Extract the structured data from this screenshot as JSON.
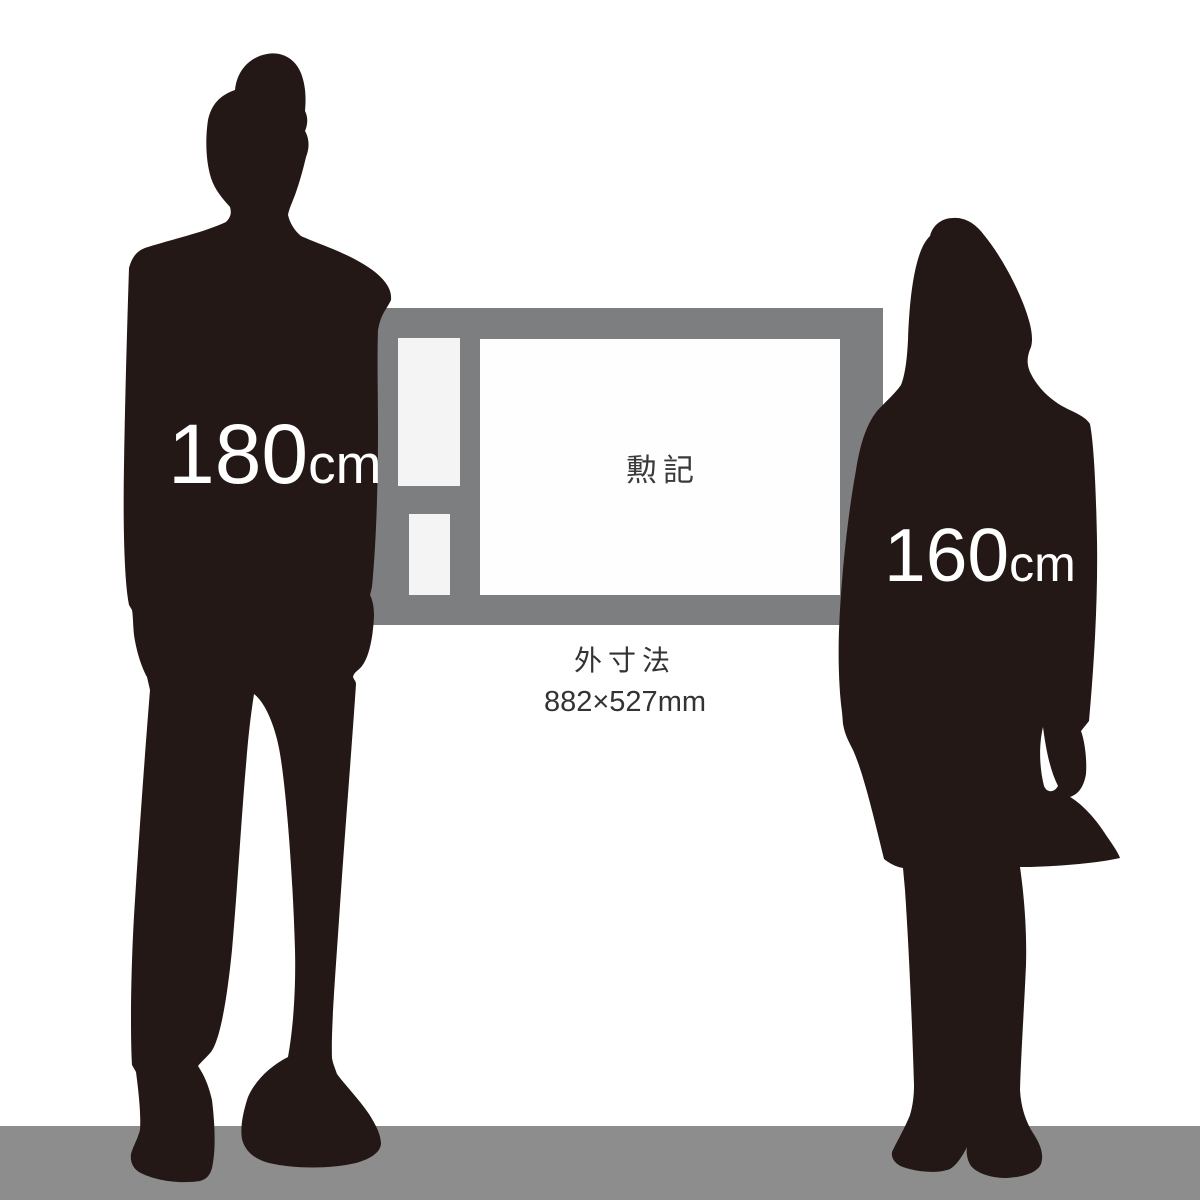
{
  "size_labels": {
    "man": {
      "value": "180",
      "unit": "cm"
    },
    "woman": {
      "value": "160",
      "unit": "cm"
    }
  },
  "certificate_frame": {
    "title": "勲記"
  },
  "dimensions_caption": {
    "label": "外寸法",
    "value": "882×527mm"
  },
  "colors": {
    "silhouette": "#231815",
    "frame": "#7d7e80",
    "mat_white": "#f4f4f4",
    "certificate_white": "#fefefe",
    "floor": "#8d8d8d",
    "caption_text": "#333333",
    "frame_title_text": "#3a3a3a",
    "height_text": "#ffffff",
    "background": "#ffffff"
  }
}
